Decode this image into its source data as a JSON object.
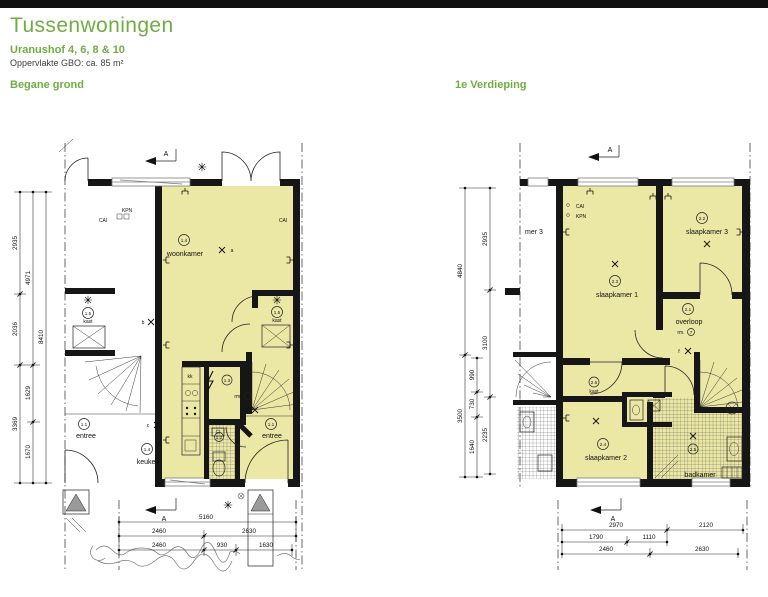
{
  "header": {
    "title": "Tussenwoningen",
    "subtitle": "Uranushof 4, 6, 8 & 10",
    "area_note": "Oppervlakte GBO: ca. 85 m²"
  },
  "colors": {
    "accent_green": "#6fad43",
    "room_fill": "#ebe7a4",
    "wall": "#161616"
  },
  "ground_floor": {
    "section_label": "Begane grond",
    "section_arrow": "A",
    "rooms": {
      "woonkamer": {
        "number": "1.4",
        "name": "woonkamer"
      },
      "keuken": {
        "number": "1.4",
        "name": "keuken"
      },
      "kast_left": {
        "number": "1.5",
        "name": "kast"
      },
      "kast_right": {
        "number": "1.5",
        "name": "kast"
      },
      "entree_left": {
        "number": "1.1",
        "name": "entree"
      },
      "entree_right": {
        "number": "1.1",
        "name": "entree"
      },
      "meterkast": {
        "number": "1.3"
      },
      "toilet": {
        "number": "1.2"
      }
    },
    "meter": {
      "label": "rm.",
      "number": "7"
    },
    "outlets": {
      "kpn": "KPN",
      "cai_left": "CAI",
      "cai_right": "CAI",
      "kk": "kk"
    },
    "light_points": {
      "a": "a",
      "b": "b",
      "c": "c",
      "d": "d"
    },
    "dims_left": {
      "col1": [
        "2935",
        "2036",
        "3369"
      ],
      "col2": [
        "4971",
        "1629",
        "1670"
      ],
      "col3": [
        "8410"
      ]
    },
    "dims_bottom": {
      "row1": [
        "5160"
      ],
      "row2": [
        "2460",
        "2630"
      ],
      "row3": [
        "2460",
        "930",
        "1630"
      ]
    }
  },
  "first_floor": {
    "section_label": "1e Verdieping",
    "section_arrow": "A",
    "rooms": {
      "slaapkamer1": {
        "number": "2.3",
        "name": "slaapkamer 1"
      },
      "slaapkamer2": {
        "number": "2.4",
        "name": "slaapkamer 2"
      },
      "slaapkamer3": {
        "number": "2.2",
        "name": "slaapkamer 3"
      },
      "overloop": {
        "number": "2.1",
        "name": "overloop"
      },
      "kast": {
        "number": "2.6",
        "name": "kast"
      },
      "badkamer": {
        "number": "2.5",
        "name": "badkamer"
      },
      "neighbor_partial": "mer 3"
    },
    "meter": {
      "label": "rm.",
      "number": "7"
    },
    "outlets": {
      "cai": "CAI",
      "kpn": "KPN"
    },
    "light_points": {
      "f": "f"
    },
    "dims_left": {
      "col1": [
        "4840",
        "3500"
      ],
      "col2": [
        "990",
        "730",
        "1640"
      ],
      "col3": [
        "2935",
        "3100",
        "2235"
      ]
    },
    "dims_bottom": {
      "row1": [
        "2970",
        "2120"
      ],
      "row2": [
        "1790",
        "1110"
      ],
      "row3": [
        "2460",
        "2630"
      ]
    }
  }
}
